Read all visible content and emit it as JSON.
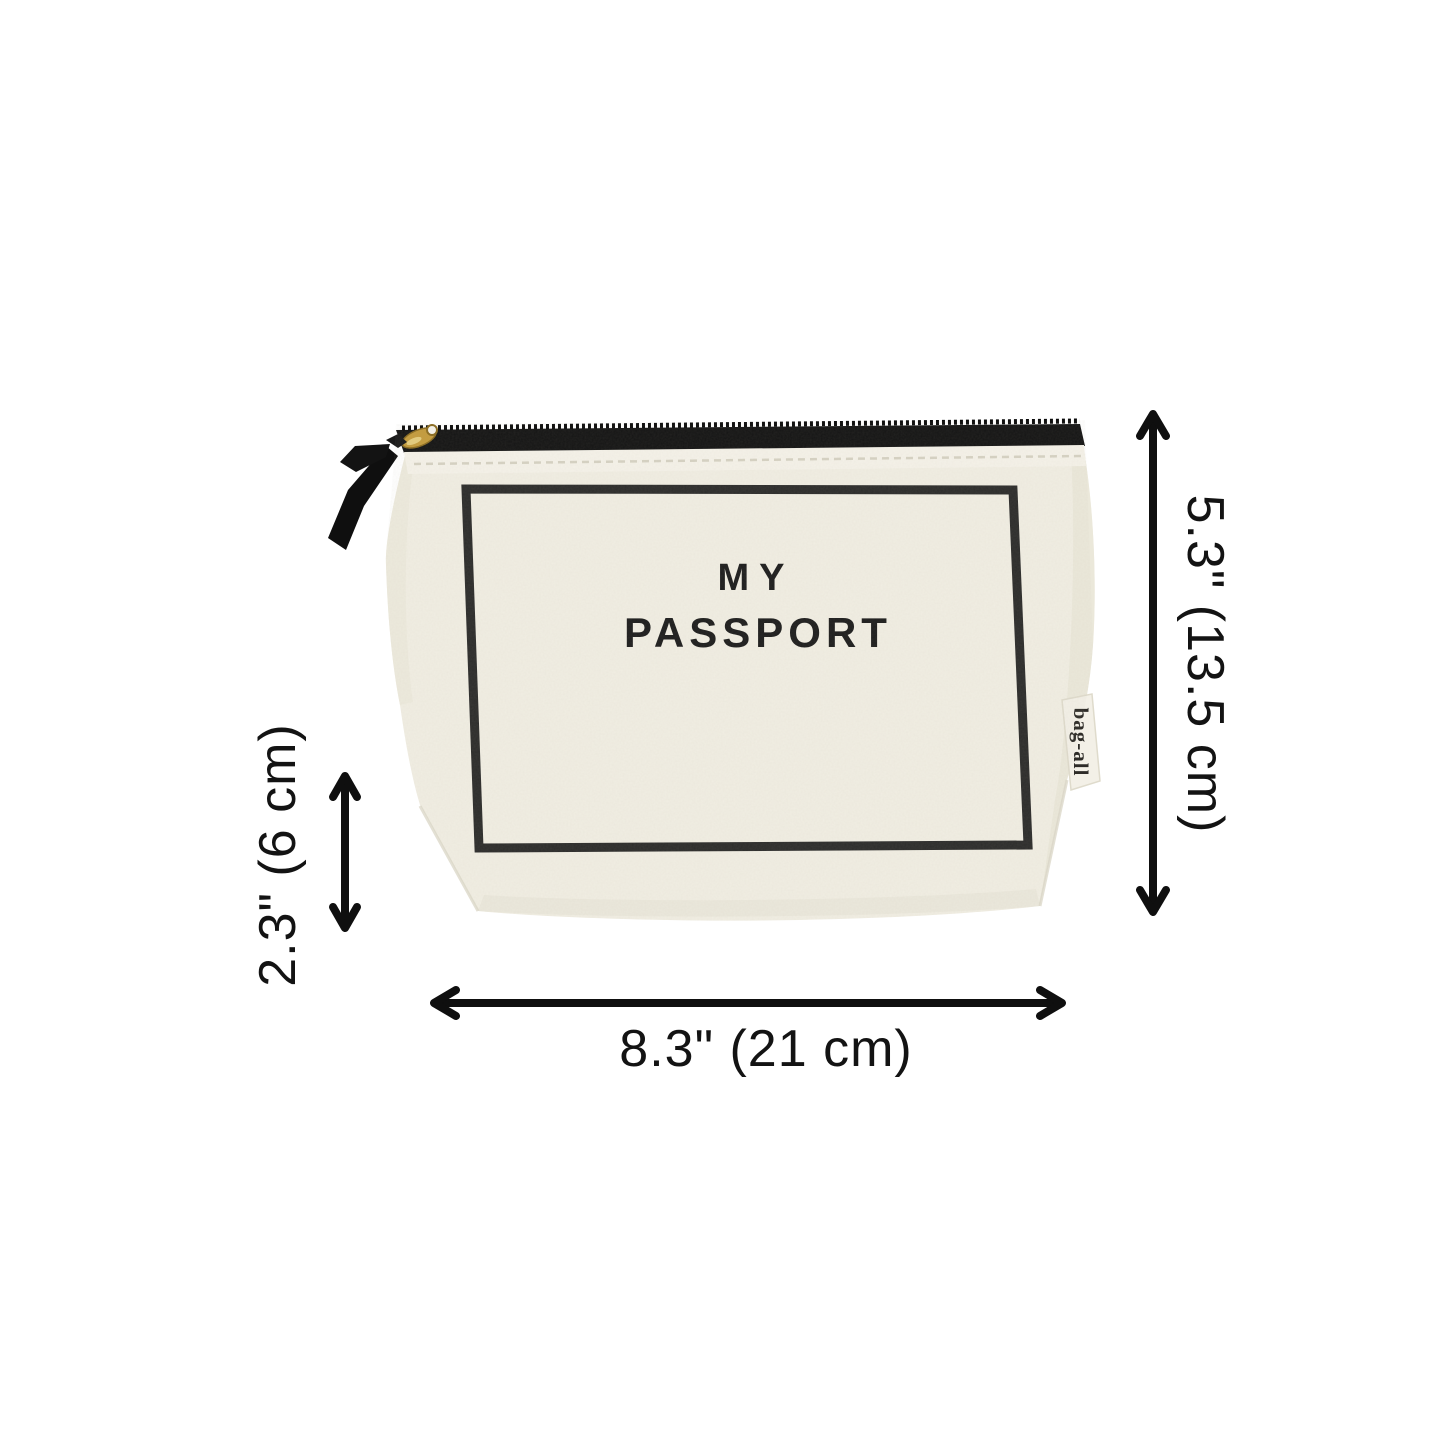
{
  "page": {
    "background": "#ffffff"
  },
  "product": {
    "front_label_line1": "MY",
    "front_label_line2": "PASSPORT",
    "brand_tag": "bag-all",
    "colors": {
      "canvas": "#f1eee3",
      "canvas_band": "#f5f2e9",
      "canvas_shadow": "#e7e4d6",
      "print": "#1e1e1e",
      "zipper_tape": "#141414",
      "zipper_pull_gold": "#c49b3c",
      "ribbon": "#0f0f0f"
    }
  },
  "annotations": {
    "color": "#0f0f0f",
    "height": {
      "label": "5.3\" (13.5 cm)"
    },
    "depth": {
      "label": "2.3\" (6 cm)"
    },
    "width": {
      "label": "8.3\" (21 cm)"
    }
  }
}
